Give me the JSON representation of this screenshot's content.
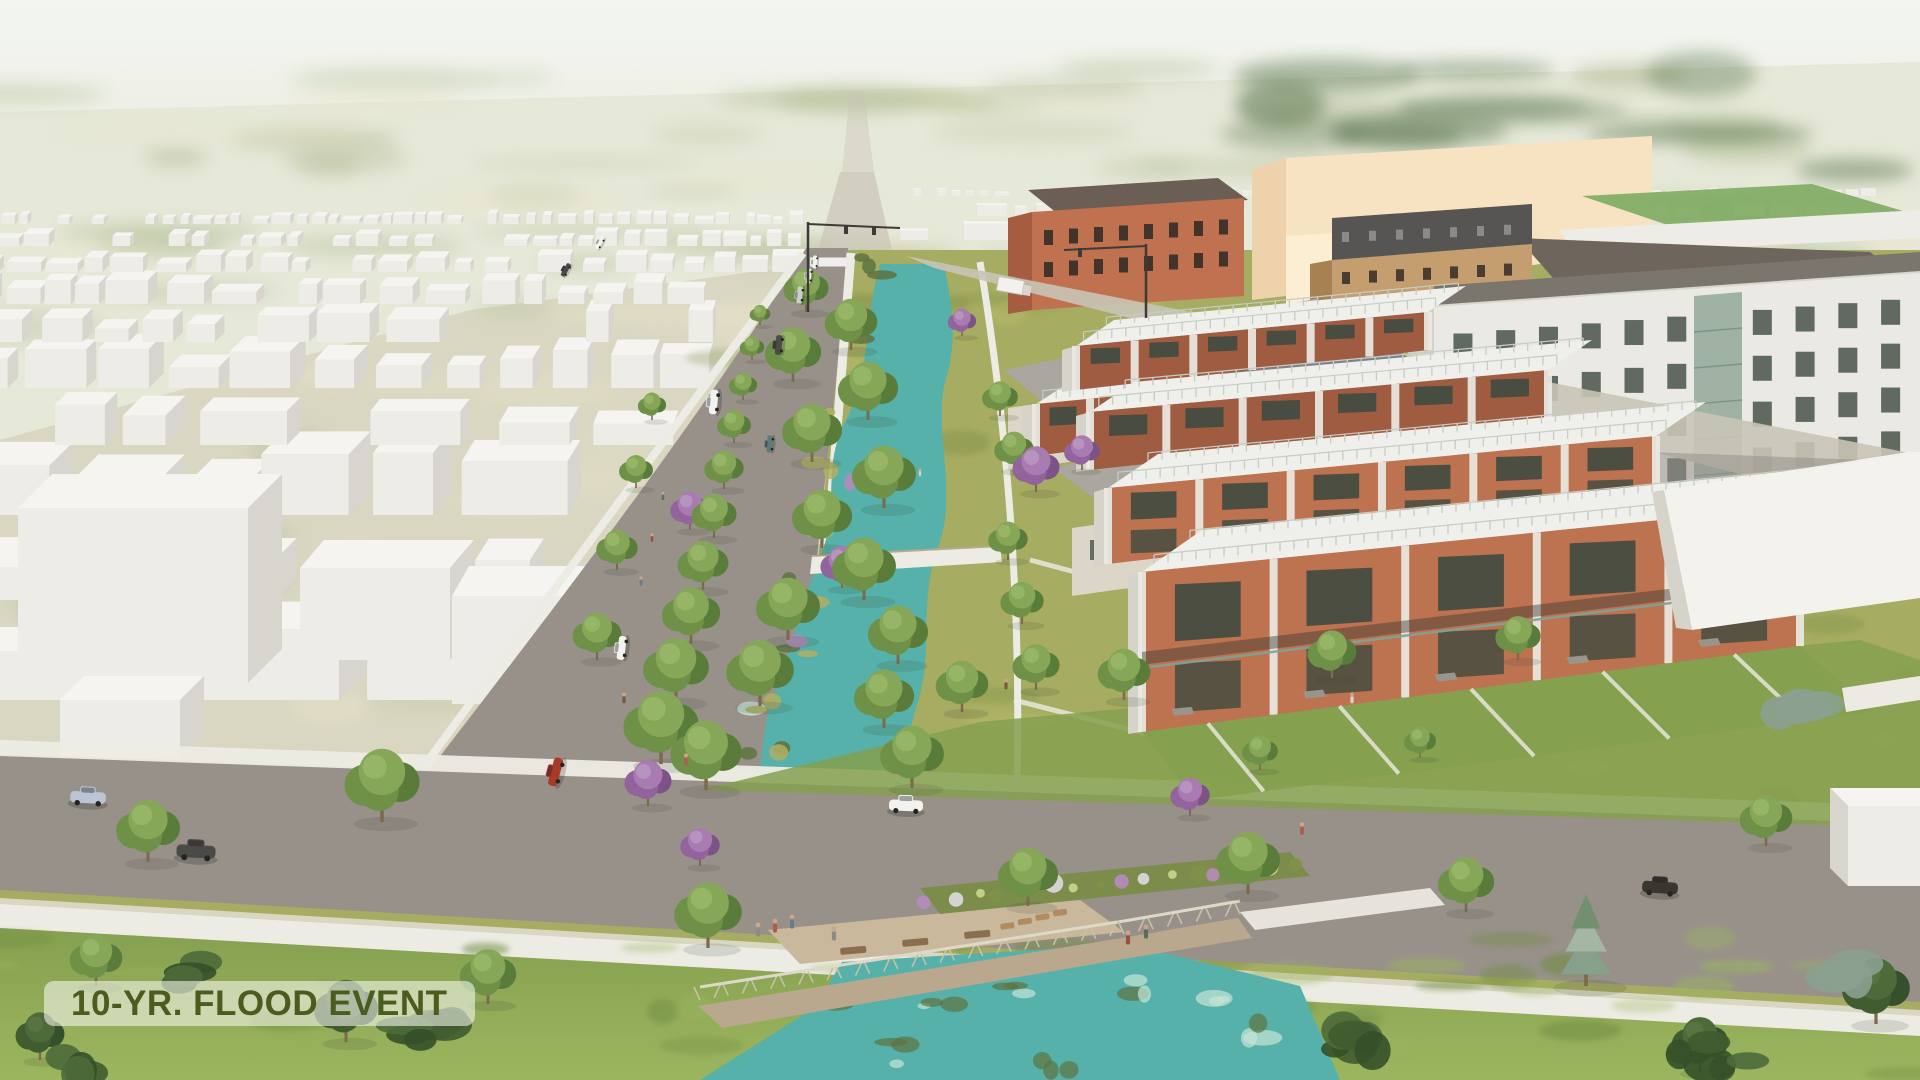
{
  "label": {
    "text": "10-YR. FLOOD EVENT"
  },
  "palette": {
    "sky_top": "#f3f5f1",
    "sky_horizon": "#eceee2",
    "terrain_far": "#e6e8d8",
    "terrain_green": "#b3c097",
    "terrain_dark": "#5f7a52",
    "terrain_pale": "#ece5cb",
    "ground_beige": "#d8d5bf",
    "ground_green": "#a9b287",
    "road": "#98918a",
    "road_far": "#c9c4b6",
    "sidewalk": "#edece4",
    "box_top": "#f6f4f0",
    "box_front": "#eeece7",
    "box_side": "#d8d5ce",
    "grass_base": "#a6ac61",
    "grass_light": "#bdc16d",
    "grass_dark": "#7f9048",
    "lawn": "#85a04f",
    "lawn_light": "#9cb55f",
    "lawn_dark": "#6f8c42",
    "water": "#55b1a9",
    "water_light": "#c5e4d6",
    "island_olive": "#afb064",
    "island_dark": "#5e7340",
    "trunk": "#7c6a4d",
    "brick": "#bd7250",
    "brick_shade": "#a05c41",
    "roof_white": "#eff0ec",
    "railing": "#c7ccc4",
    "window_dark": "#3f4a40",
    "white_wall": "#eae9e3",
    "white_wall_shade": "#d6d3cb",
    "roof_band": "#7a756d",
    "glass": "#9fb2a4",
    "peach": "#f7e3c2",
    "peach_shade": "#eed2ab",
    "peach_light": "#fbeed3",
    "orange_wall": "#c07150",
    "orange_side": "#a55c40",
    "orange_roof": "#6a5e55",
    "tan_wall": "#c49e6e",
    "tan_side": "#a88153",
    "dark_top": "#565553",
    "dark_roof": "#6e665d",
    "house_roof_blue": "#7d838d",
    "house_roof_gray": "#aaa7a0",
    "house_wall": "#dcd6c9",
    "deck": "#b9a88e",
    "deck_light": "#c9b89c",
    "planter_green": "#7c8d4b",
    "flower_purple": "#b78bc0",
    "flower_white": "#dfd9e2",
    "flower_yellow": "#c7d98e",
    "field_green": "#84ae67",
    "pole": "#3c3b38",
    "awning": "#9a958c",
    "band_dark": "#3d3c36",
    "balcony_glass": "#7fa39b",
    "juniper": "#8ba08f",
    "label_bg": "rgba(246,248,240,0.58)",
    "label_text": "#4b5c1e",
    "car_white": "#f2f2ef",
    "car_silver": "#cccdc9",
    "car_dark": "#4a4a46",
    "car_black": "#38362f",
    "car_blue": "#b9c5d3",
    "car_red": "#a83a28",
    "car_teal": "#5d7b78",
    "skin": "#caa78a",
    "tree_types": {
      "g": [
        "#86a758",
        "#6e9147",
        "#597c3a",
        "#9dbb6d"
      ],
      "p": [
        "#a87cb1",
        "#93639d",
        "#7d5287",
        "#c09cc6"
      ],
      "d": [
        "#4d6a3a",
        "#405c30",
        "#35502a",
        "#5d7a45"
      ]
    },
    "spruce": [
      "#a3b7a4",
      "#87a089",
      "#72906f"
    ],
    "figure_colors": [
      "#b35b4a",
      "#6b7a8c",
      "#96543f",
      "#5d6e52",
      "#d8d3c8",
      "#7a5a3c",
      "#8c8c86"
    ]
  }
}
